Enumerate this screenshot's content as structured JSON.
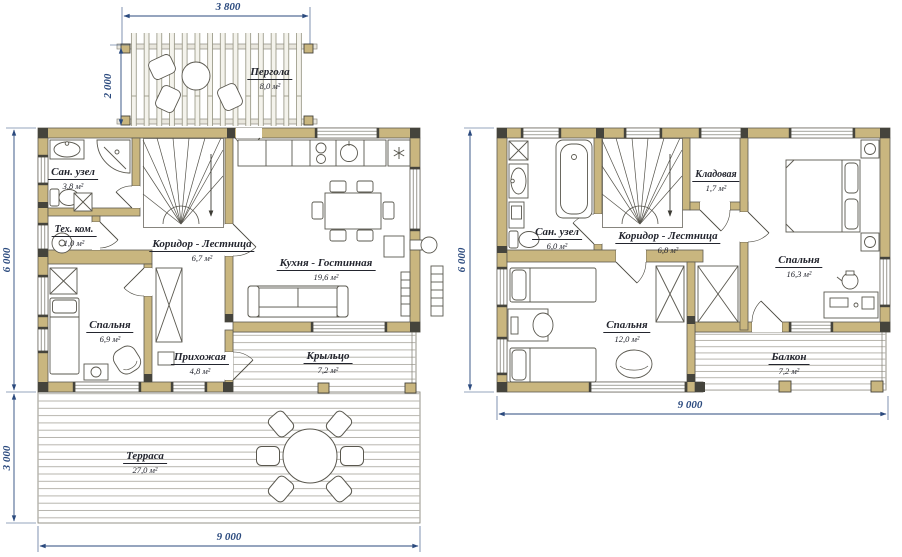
{
  "sheet": {
    "type": "house floor plan drawing",
    "units": "mm"
  },
  "colors": {
    "wall_fill": "#c9b67f",
    "wall_edge": "#5d5b52",
    "corner_block": "#45443c",
    "dimension": "#2b4a7e",
    "label_text": "#23252e",
    "furniture_line": "#5a584f",
    "plank_line": "#b7b5ae",
    "background": "#ffffff"
  },
  "icons": {
    "fridge": "snowflake-icon",
    "stairs_direction": "down-arrow-icon"
  },
  "plan1": {
    "name": "first floor",
    "rooms": {
      "pergola": {
        "label": "Пергола",
        "area": "8,0 м²"
      },
      "san_uzel": {
        "label": "Сан. узел",
        "area": "3,8 м²"
      },
      "tech": {
        "label": "Тех. ком.",
        "area": "1,0 м²"
      },
      "corridor": {
        "label": "Коридор - Лестница",
        "area": "6,7 м²"
      },
      "kitchen": {
        "label": "Кухня - Гостинная",
        "area": "19,6 м²"
      },
      "bedroom": {
        "label": "Спальня",
        "area": "6,9 м²"
      },
      "hallway": {
        "label": "Прихожая",
        "area": "4,8 м²"
      },
      "porch": {
        "label": "Крыльцо",
        "area": "7,2 м²"
      },
      "terrace": {
        "label": "Терраса",
        "area": "27,0 м²"
      }
    },
    "dimensions": {
      "pergola_width": "3 800",
      "pergola_depth": "2 000",
      "house_depth": "6 000",
      "terrace_depth": "3 000",
      "house_width": "9 000"
    }
  },
  "plan2": {
    "name": "second floor",
    "rooms": {
      "san_uzel": {
        "label": "Сан. узел",
        "area": "6,0 м²"
      },
      "storage": {
        "label": "Кладовая",
        "area": "1,7 м²"
      },
      "corridor": {
        "label": "Коридор - Лестница",
        "area": "6,8 м²"
      },
      "bedroom_large": {
        "label": "Спальня",
        "area": "16,3 м²"
      },
      "bedroom_small": {
        "label": "Спальня",
        "area": "12,0 м²"
      },
      "balcony": {
        "label": "Балкон",
        "area": "7,2 м²"
      }
    },
    "dimensions": {
      "house_depth": "6 000",
      "house_width": "9 000"
    }
  }
}
